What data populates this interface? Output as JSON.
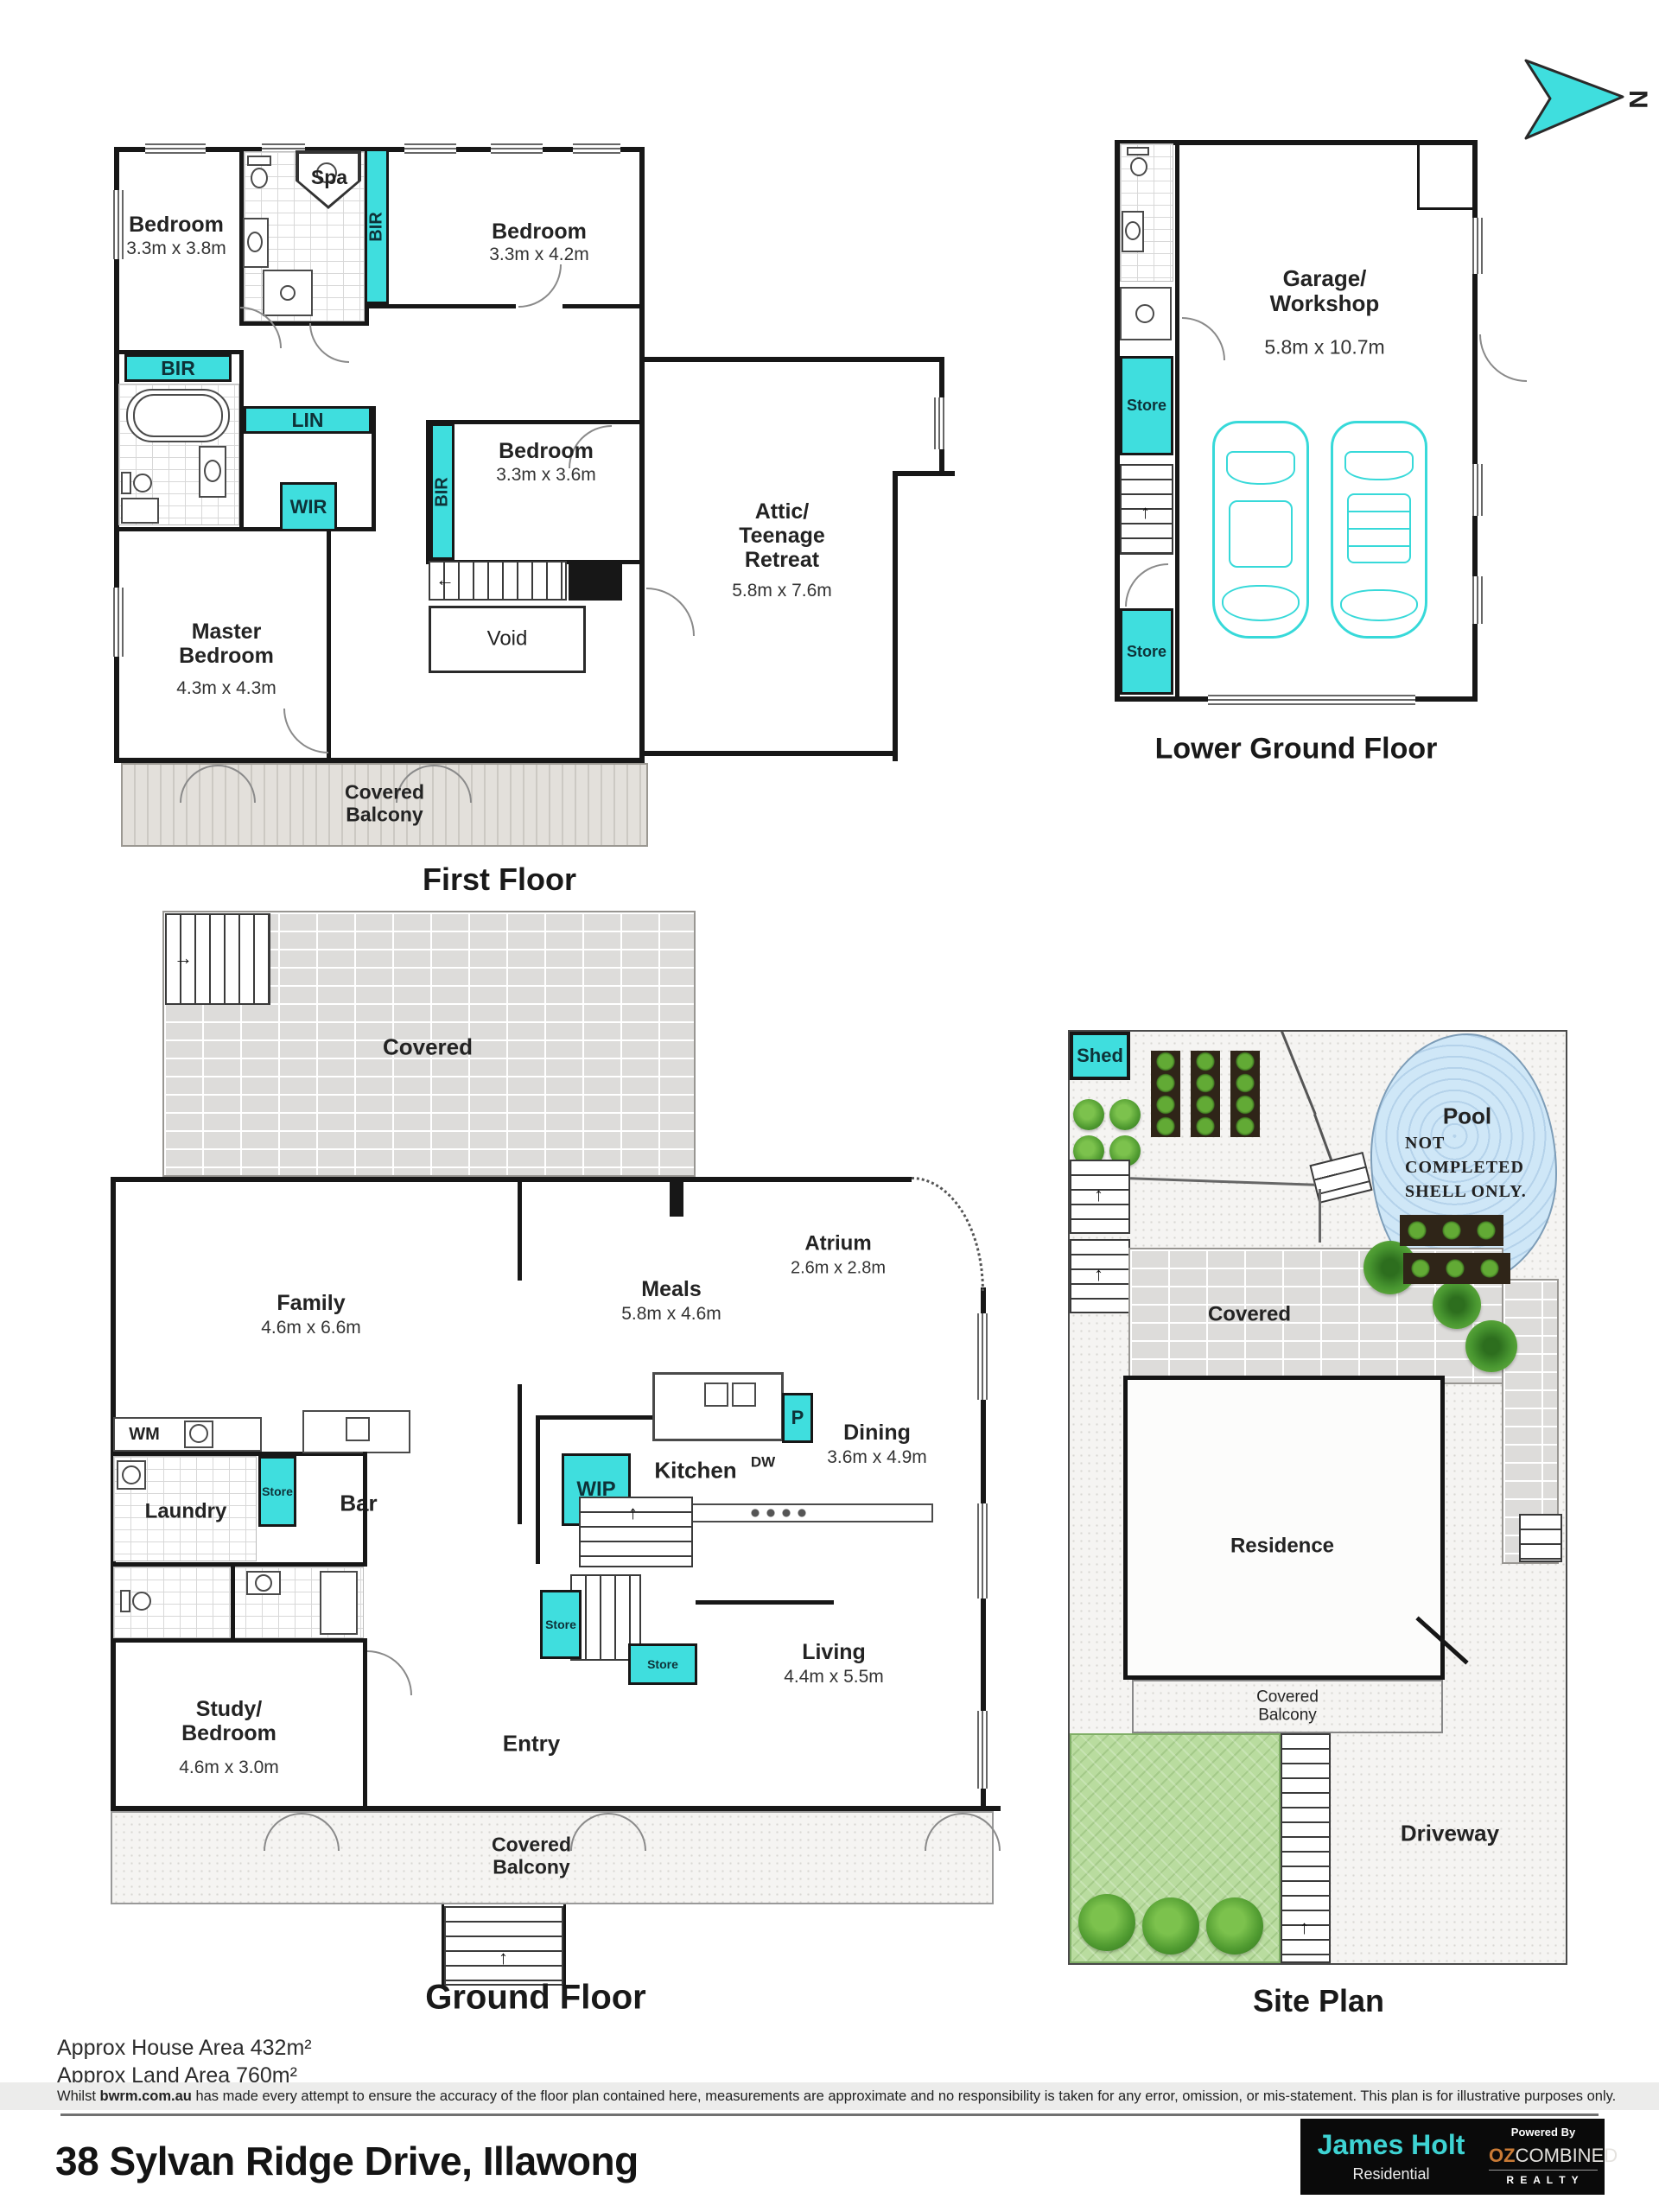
{
  "north": {
    "label": "N"
  },
  "first_floor": {
    "title": "First Floor",
    "bedroom1": {
      "name": "Bedroom",
      "dims": "3.3m x 3.8m"
    },
    "bedroom2": {
      "name": "Bedroom",
      "dims": "3.3m x 4.2m"
    },
    "bedroom3": {
      "name": "Bedroom",
      "dims": "3.3m x 3.6m"
    },
    "master": {
      "name": "Master Bedroom",
      "dims": "4.3m x 4.3m"
    },
    "attic": {
      "name": "Attic/ Teenage Retreat",
      "dims": "5.8m x 7.6m"
    },
    "spa": "Spa",
    "void": "Void",
    "balcony": "Covered Balcony",
    "bir_top": "BIR",
    "bir_left": "BIR",
    "bir_bed3": "BIR",
    "lin": "LIN",
    "wir": "WIR"
  },
  "lower_ground": {
    "title": "Lower Ground Floor",
    "garage": {
      "name": "Garage/ Workshop",
      "dims": "5.8m x 10.7m"
    },
    "store1": "Store",
    "store2": "Store"
  },
  "ground_floor": {
    "title": "Ground Floor",
    "covered": "Covered",
    "family": {
      "name": "Family",
      "dims": "4.6m x 6.6m"
    },
    "meals": {
      "name": "Meals",
      "dims": "5.8m x 4.6m"
    },
    "atrium": {
      "name": "Atrium",
      "dims": "2.6m x 2.8m"
    },
    "dining": {
      "name": "Dining",
      "dims": "3.6m x 4.9m"
    },
    "living": {
      "name": "Living",
      "dims": "4.4m x 5.5m"
    },
    "study": {
      "name": "Study/ Bedroom",
      "dims": "4.6m x 3.0m"
    },
    "entry": "Entry",
    "kitchen": "Kitchen",
    "laundry": "Laundry",
    "bar": "Bar",
    "wm": "WM",
    "dw": "DW",
    "wip": "WIP",
    "pantry": "P",
    "store_laundry": "Store",
    "store_stair1": "Store",
    "store_stair2": "Store",
    "balcony": "Covered Balcony"
  },
  "site_plan": {
    "title": "Site Plan",
    "shed": "Shed",
    "pool": "Pool",
    "pool_note": [
      "NOT",
      "COMPLETED",
      "SHELL ONLY."
    ],
    "covered": "Covered",
    "residence": "Residence",
    "balcony": "Covered Balcony",
    "driveway": "Driveway"
  },
  "footer": {
    "house_area": "Approx House Area 432m²",
    "land_area": "Approx Land Area 760m²",
    "disclaimer_prefix": "Whilst ",
    "disclaimer_bold": "bwrm.com.au",
    "disclaimer_rest": " has made every attempt to ensure the accuracy of the floor plan contained here, measurements are approximate and no responsibility is taken for any error, omission, or mis-statement. This plan is for illustrative purposes only.",
    "address": "38 Sylvan Ridge Drive, Illawong"
  },
  "brand": {
    "name": "James Holt",
    "sub": "Residential",
    "powered_by": "Powered By",
    "oz": "OZ",
    "combined": "COMBINED",
    "realty": "R E A L T Y"
  },
  "colors": {
    "accent_cyan": "#3FDEDE",
    "brand_cyan": "#3ED3D3",
    "oz_orange": "#C97A35"
  }
}
